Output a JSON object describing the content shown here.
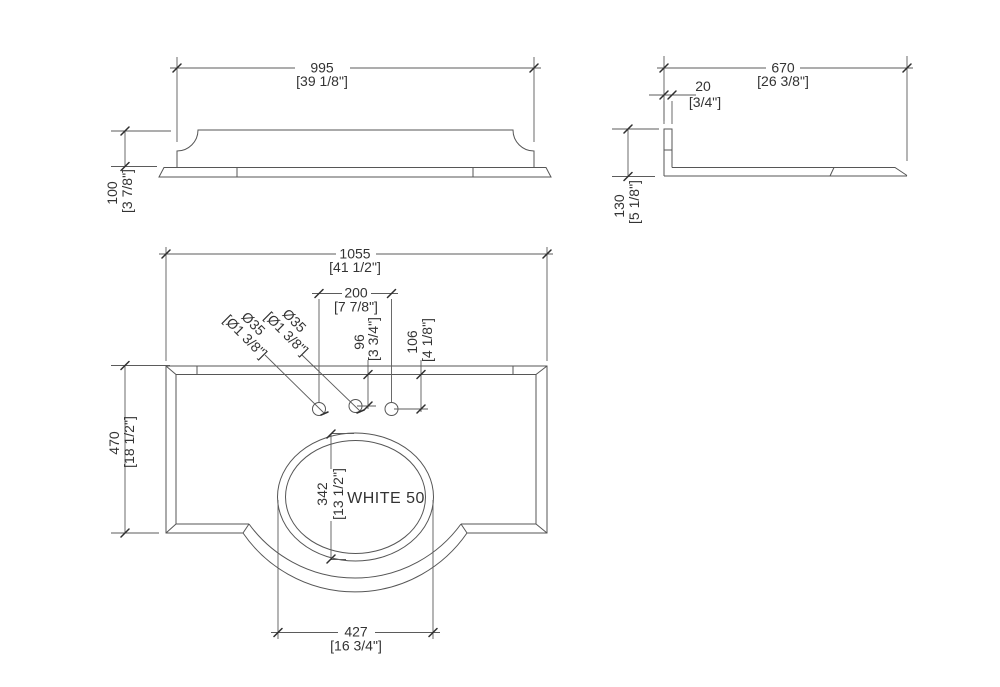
{
  "drawing_label": "WHITE 50",
  "views": {
    "front": {
      "width": {
        "mm": "995",
        "in": "[39 1/8\"]"
      },
      "height": {
        "mm": "100",
        "in": "[3 7/8\"]"
      }
    },
    "side": {
      "depth": {
        "mm": "670",
        "in": "[26 3/8\"]"
      },
      "backsplash": {
        "mm": "20",
        "in": "[3/4\"]"
      },
      "height": {
        "mm": "130",
        "in": "[5 1/8\"]"
      }
    },
    "plan": {
      "width": {
        "mm": "1055",
        "in": "[41 1/2\"]"
      },
      "depth": {
        "mm": "470",
        "in": "[18 1/2\"]"
      },
      "hole_spacing": {
        "mm": "200",
        "in": "[7 7/8\"]"
      },
      "hole_diameter_left": {
        "mm": "Ø35",
        "in": "[Ø1 3/8\"]"
      },
      "hole_diameter_center": {
        "mm": "Ø35",
        "in": "[Ø1 3/8\"]"
      },
      "center_hole_setback": {
        "mm": "96",
        "in": "[3 3/4\"]"
      },
      "side_hole_setback": {
        "mm": "106",
        "in": "[4 1/8\"]"
      },
      "basin_front_to_back": {
        "mm": "342",
        "in": "[13 1/2\"]"
      },
      "basin_width": {
        "mm": "427",
        "in": "[16 3/4\"]"
      }
    }
  },
  "colors": {
    "background": "#ffffff",
    "geometry_line": "#565656",
    "dimension_line": "#5b5b5b",
    "text": "#333333"
  }
}
